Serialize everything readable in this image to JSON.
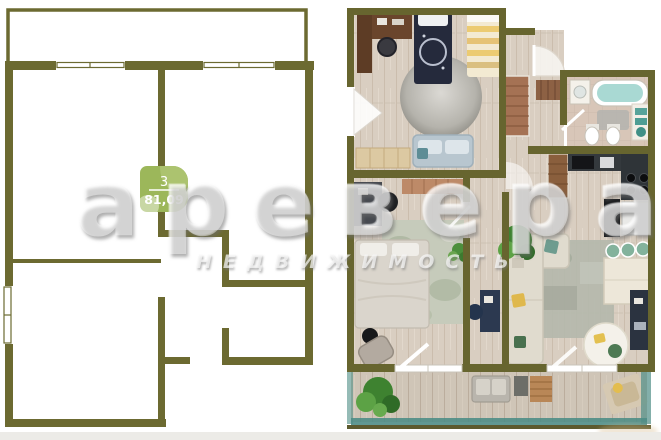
{
  "plan_badge": {
    "rooms_count": "3",
    "area_m2": "81,09",
    "badge_color": "#9cb75a"
  },
  "watermark": {
    "brand": "аревера",
    "subtitle": "НЕДВИЖИМОСТЬ"
  },
  "colors": {
    "wall_olive_2d": "#6c6a31",
    "wall_olive_3d": "#67652f",
    "floor_wood": "#d9cec1",
    "floor_balcony": "#cfc5b7",
    "bathroom_floor": "#d8c6b8",
    "balcony_glass_teal": "#4f8d86",
    "footer_strip": "#ecebe7"
  }
}
